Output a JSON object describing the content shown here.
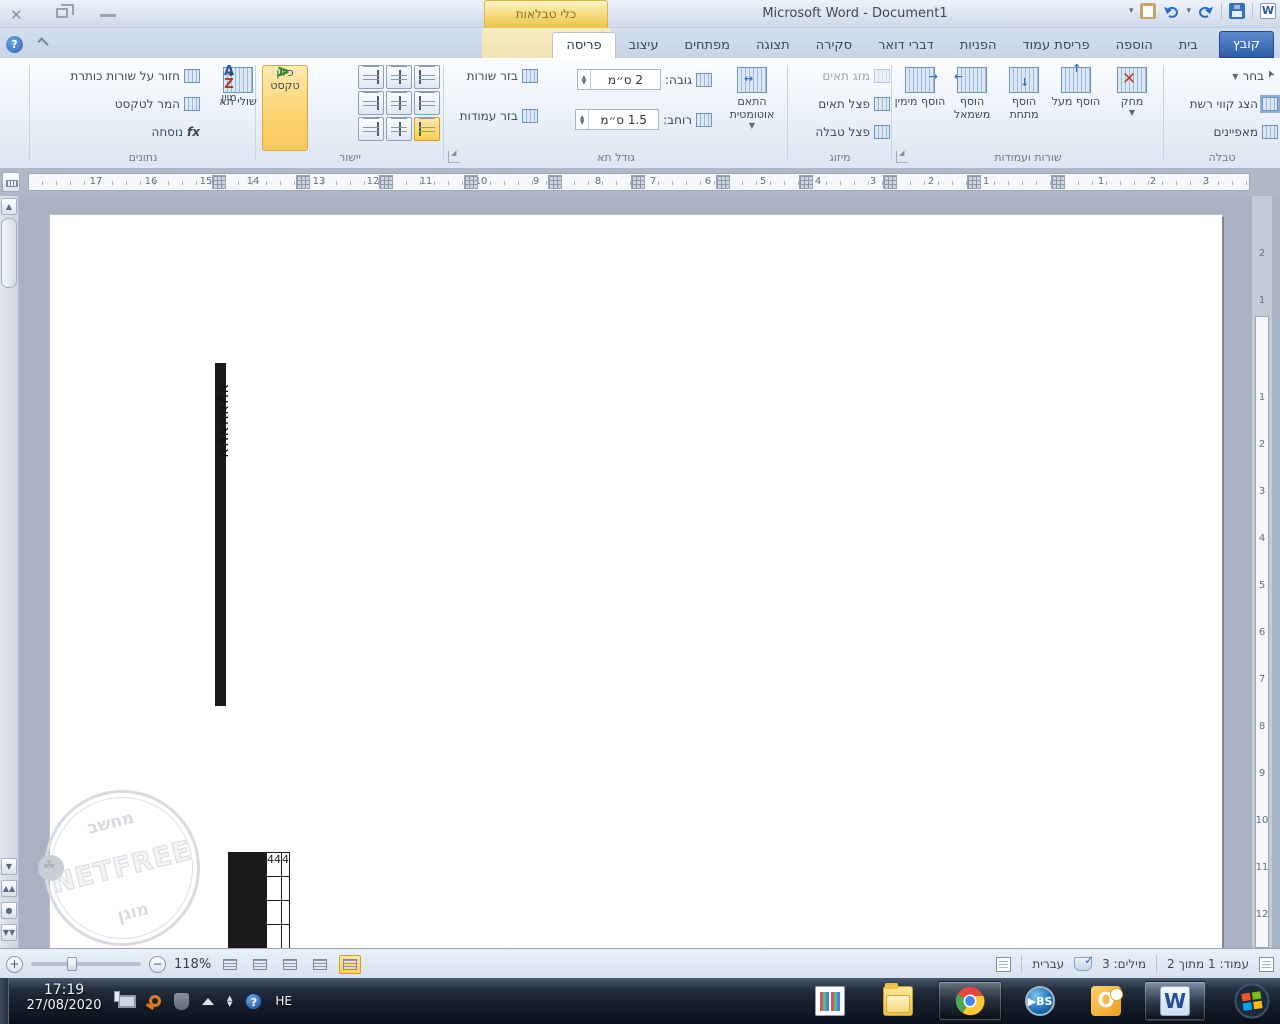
{
  "titlebar": {
    "title": "Microsoft Word - Document1",
    "contextual_group_label": "כלי טבלאות"
  },
  "tabs": {
    "file": "קובץ",
    "items": [
      "בית",
      "הוספה",
      "פריסת עמוד",
      "הפניות",
      "דברי דואר",
      "סקירה",
      "תצוגה",
      "מפתחים"
    ],
    "contextual": [
      "עיצוב",
      "פריסה"
    ],
    "active": "פריסה"
  },
  "ribbon": {
    "table_group": {
      "label": "טבלה",
      "select": "בחר",
      "view_gridlines": "הצג קווי רשת",
      "properties": "מאפיינים"
    },
    "rows_columns_group": {
      "label": "שורות ועמודות",
      "delete": "מחק",
      "insert_above": "הוסף מעל",
      "insert_below": "הוסף מתחת",
      "insert_left": "הוסף משמאל",
      "insert_right": "הוסף מימין"
    },
    "merge_group": {
      "label": "מיזוג",
      "merge_cells": "מזג תאים",
      "split_cells": "פצל תאים",
      "split_table": "פצל טבלה"
    },
    "cell_size_group": {
      "label": "גודל תא",
      "autofit": "התאם אוטומטית",
      "height_label": "גובה:",
      "height_value": "2 ס״מ",
      "width_label": "רוחב:",
      "width_value": "1.5 ס״מ",
      "distribute_rows": "בזר שורות",
      "distribute_columns": "בזר עמודות"
    },
    "alignment_group": {
      "label": "יישור",
      "text_direction": "כיוון טקסט",
      "cell_margins": "שולי תא"
    },
    "data_group": {
      "label": "נתונים",
      "sort": "מיין",
      "repeat_header_rows": "חזור על שורות כותרת",
      "convert_to_text": "המר לטקסט",
      "formula": "נוסחה"
    }
  },
  "ruler": {
    "h_numbers": [
      {
        "t": "17",
        "x": 67
      },
      {
        "t": "16",
        "x": 122
      },
      {
        "t": "15",
        "x": 177
      },
      {
        "t": "14",
        "x": 224
      },
      {
        "t": "13",
        "x": 290
      },
      {
        "t": "12",
        "x": 344
      },
      {
        "t": "11",
        "x": 397
      },
      {
        "t": "10",
        "x": 452
      },
      {
        "t": "9",
        "x": 507
      },
      {
        "t": "8",
        "x": 569
      },
      {
        "t": "7",
        "x": 624
      },
      {
        "t": "6",
        "x": 679
      },
      {
        "t": "5",
        "x": 734
      },
      {
        "t": "4",
        "x": 789
      },
      {
        "t": "3",
        "x": 844
      },
      {
        "t": "2",
        "x": 902
      },
      {
        "t": "1",
        "x": 957
      },
      {
        "t": "1",
        "x": 1072
      },
      {
        "t": "2",
        "x": 1124
      },
      {
        "t": "3",
        "x": 1177
      }
    ],
    "v_margin_numbers": [
      {
        "t": "2",
        "y": 52
      },
      {
        "t": "1",
        "y": 99
      }
    ],
    "v_numbers": [
      {
        "t": "1",
        "y": 196
      },
      {
        "t": "2",
        "y": 243
      },
      {
        "t": "3",
        "y": 290
      },
      {
        "t": "4",
        "y": 337
      },
      {
        "t": "5",
        "y": 384
      },
      {
        "t": "6",
        "y": 431
      },
      {
        "t": "7",
        "y": 478
      },
      {
        "t": "8",
        "y": 525
      },
      {
        "t": "9",
        "y": 572
      },
      {
        "t": "10",
        "y": 619
      },
      {
        "t": "11",
        "y": 666
      },
      {
        "t": "12",
        "y": 713
      }
    ]
  },
  "document": {
    "table1": {
      "columns": 10,
      "row_heights": [
        115,
        25,
        26,
        25,
        26,
        25,
        26,
        74
      ],
      "x": 165,
      "y": 148,
      "col_width": 84.2,
      "cells": [
        {
          "r": 0,
          "c": 9,
          "text": "אעאעאעא",
          "rotated": true
        }
      ]
    },
    "table2": {
      "narrow_columns": 38,
      "narrow_width": 20.2,
      "wide_widths": [
        31,
        22
      ],
      "row_heights": [
        24,
        24,
        24,
        24
      ],
      "x": 178,
      "y": 637,
      "cells": [
        {
          "r": 0,
          "c": 38,
          "text": "44"
        },
        {
          "r": 0,
          "c": 39,
          "text": "4"
        }
      ]
    },
    "watermark": {
      "top": "מחשב",
      "middle": "NETFREE",
      "bottom": "מוגן"
    }
  },
  "status_bar": {
    "page": "עמוד: 1 מתוך 2",
    "words": "מילים: 3",
    "language": "עברית",
    "zoom": "118%"
  },
  "taskbar": {
    "time": "17:19",
    "date": "27/08/2020",
    "tray_language": "HE",
    "apps": [
      "calculator",
      "explorer",
      "chrome",
      "bs-player",
      "outlook",
      "word"
    ],
    "bs_label": "BS",
    "outlook_label": "O",
    "word_label": "W"
  }
}
